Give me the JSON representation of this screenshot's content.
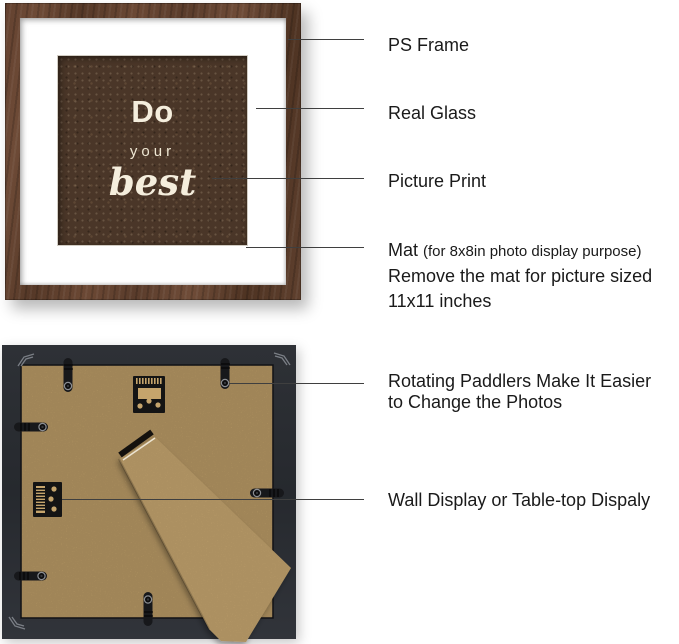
{
  "front_view": {
    "picture_text": {
      "word1": "Do",
      "word2": "your",
      "word3": "best"
    }
  },
  "callouts_front": {
    "ps_frame": "PS Frame",
    "real_glass": "Real Glass",
    "picture_print": "Picture Print",
    "mat_title": "Mat",
    "mat_note": "(for 8x8in photo display purpose)",
    "mat_line2": "Remove the mat for picture sized",
    "mat_line3": "11x11 inches"
  },
  "callouts_back": {
    "paddlers_line1": "Rotating Paddlers Make It Easier",
    "paddlers_line2": "to Change the Photos",
    "display": "Wall Display or Table-top Dispaly"
  },
  "colors": {
    "frame_wood": "#5e3f2e",
    "mat": "#ffffff",
    "picture_background": "#4a3628",
    "picture_text": "#f5eedd",
    "back_frame": "#2a2d32",
    "mdf_board": "#c5a46c",
    "easel_stand": "#ccab73",
    "hardware_black": "#17181b",
    "annotation_text": "#1a1a1a",
    "annotation_line": "#3f3f3f"
  }
}
